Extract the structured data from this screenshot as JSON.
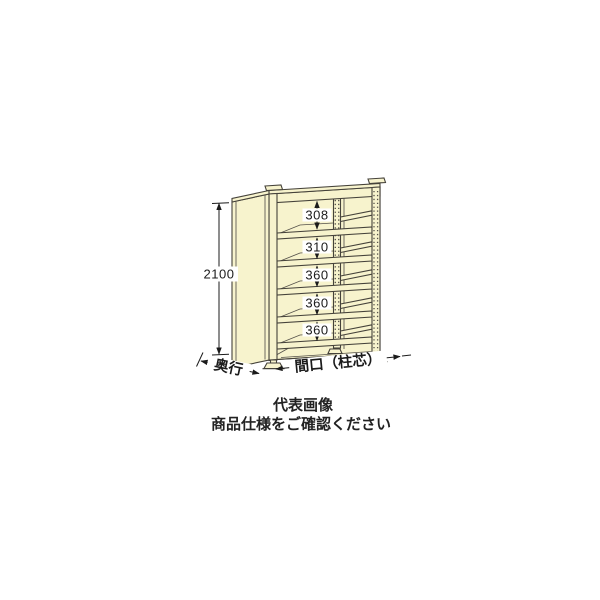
{
  "diagram": {
    "height_dim": "2100",
    "shelf_gaps": [
      "308",
      "310",
      "360",
      "360",
      "360"
    ],
    "depth_dim_label": "奥行",
    "width_dim_label": "間口（柱芯）",
    "colors": {
      "body": "#f7f3cd",
      "outline": "#45423a",
      "dimension": "#1b1b1b",
      "background": "#ffffff"
    }
  },
  "caption": {
    "line1": "代表画像",
    "line2": "商品仕様をご確認ください"
  }
}
